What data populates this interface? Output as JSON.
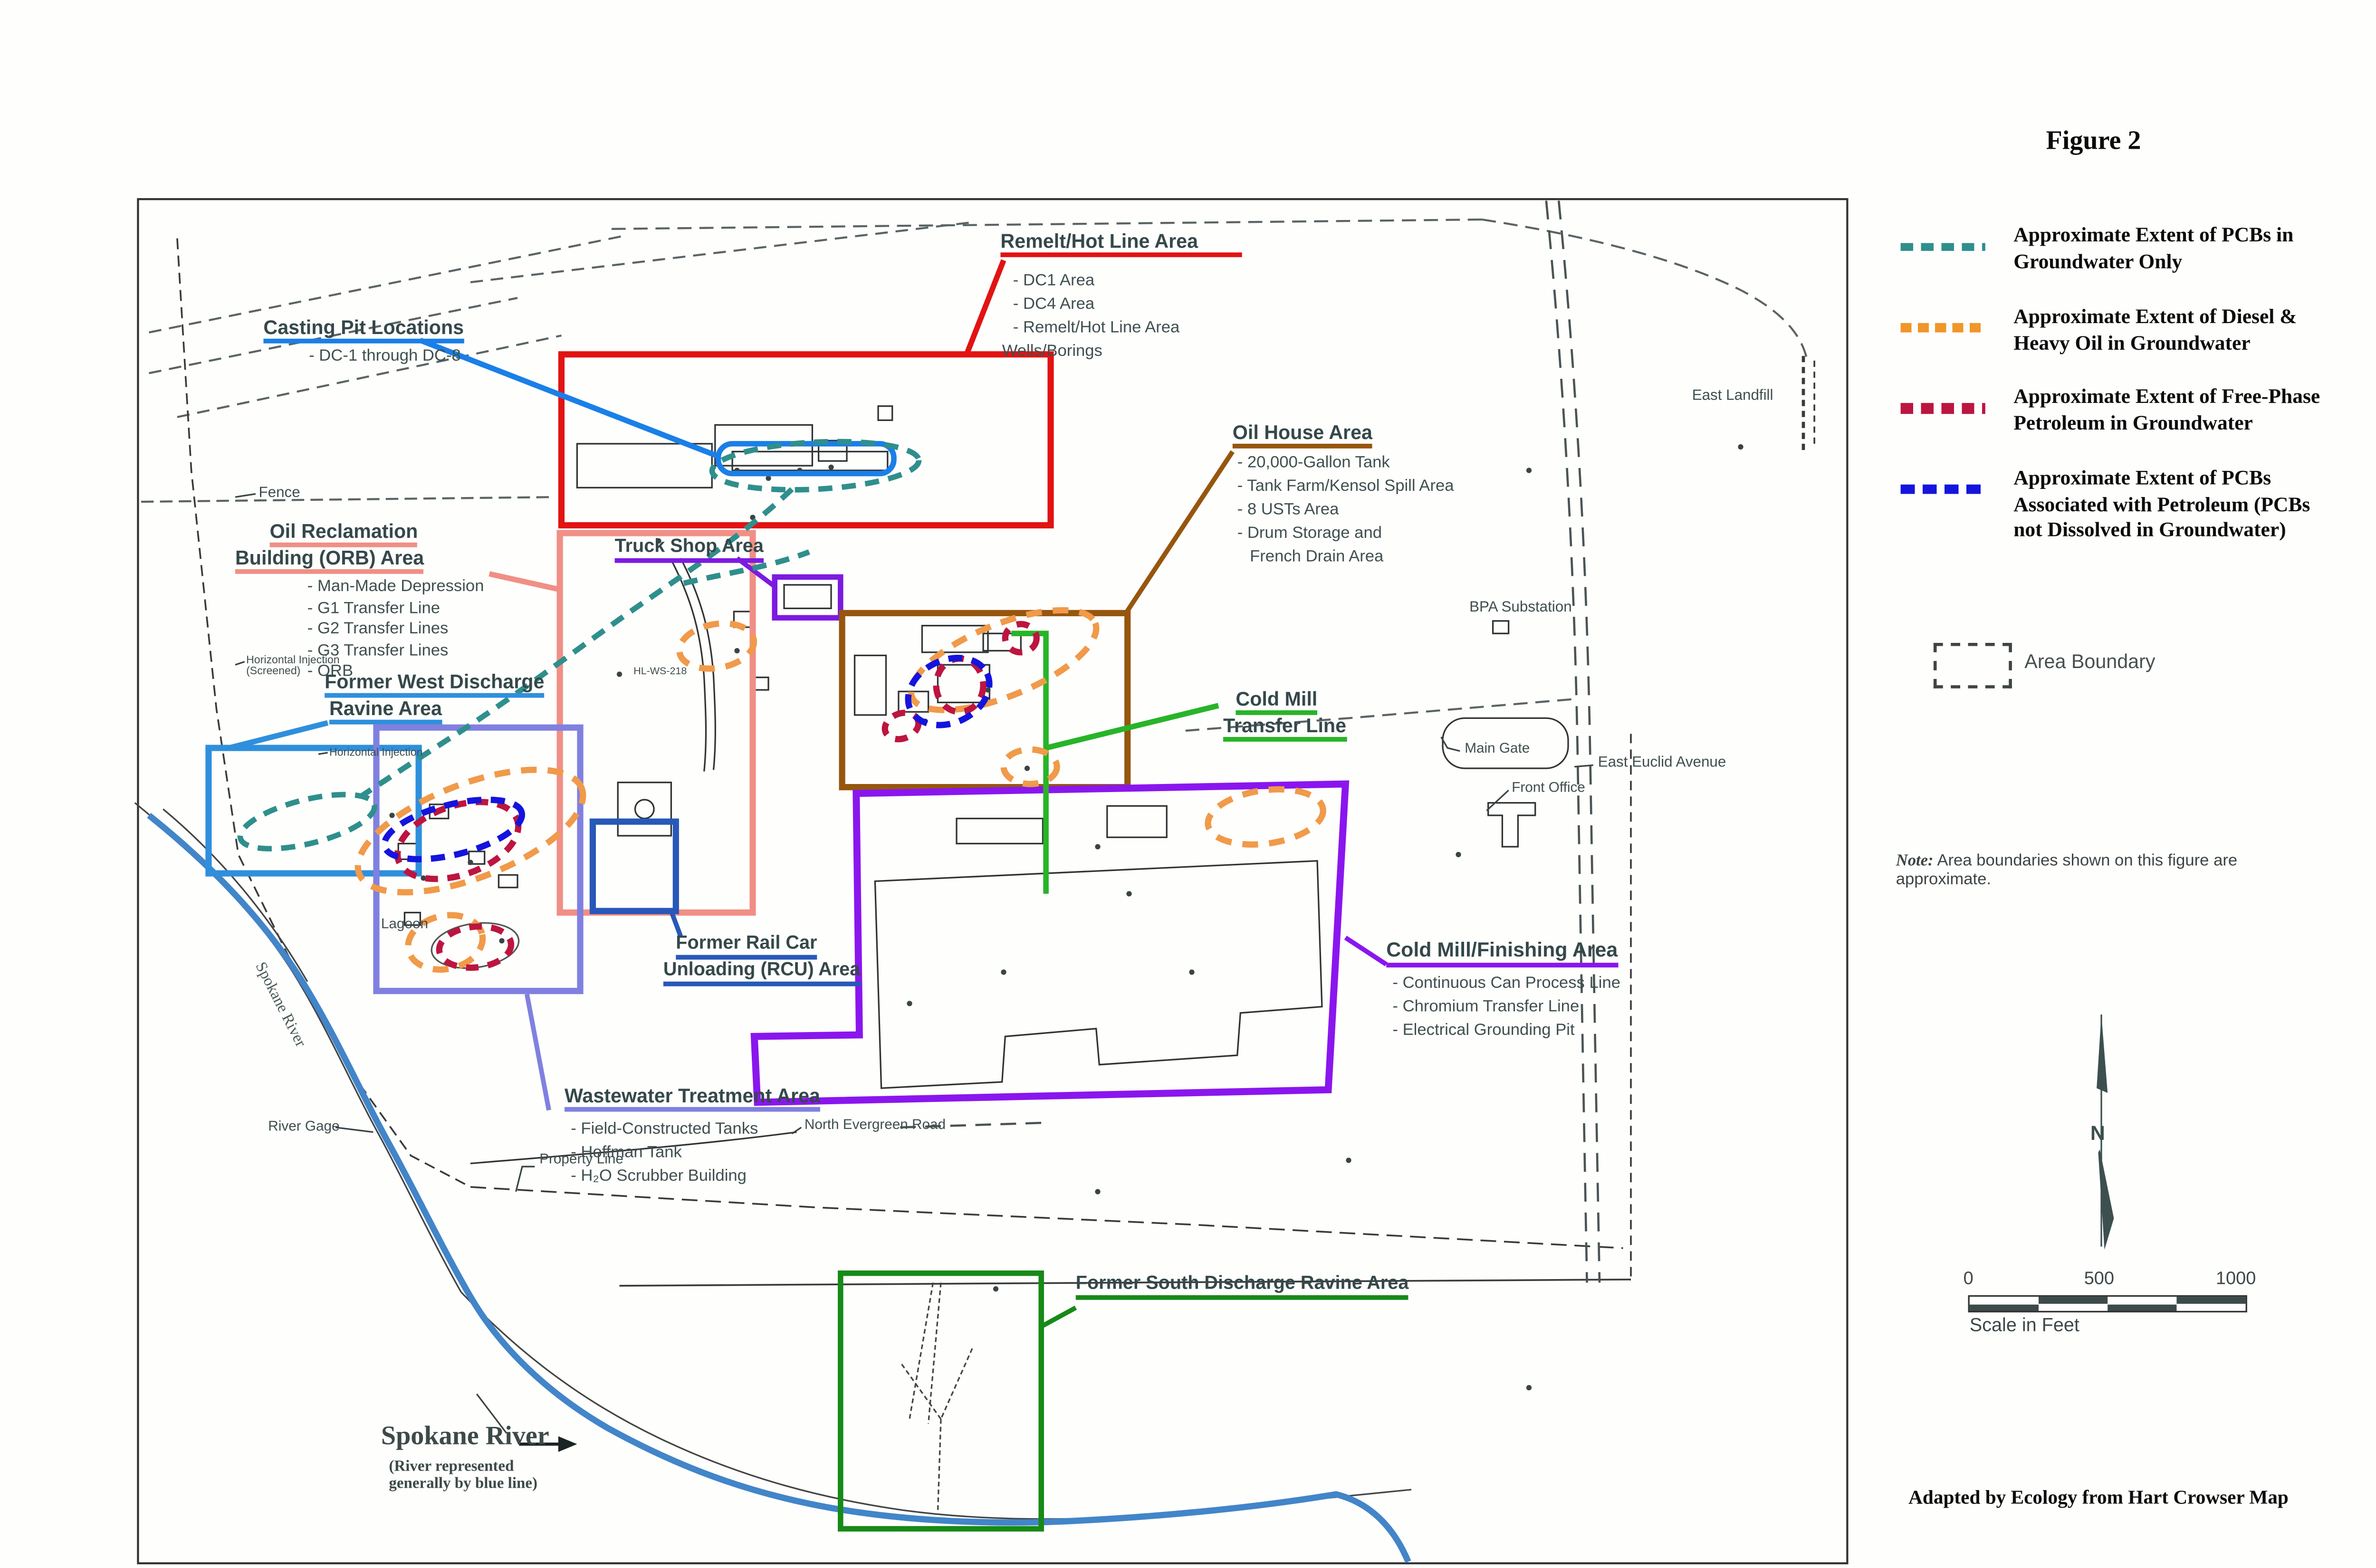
{
  "figure": {
    "title": "Figure 2",
    "north": "N",
    "note_prefix": "Note:",
    "note_text": " Area boundaries shown on this figure are approximate.",
    "credit": "Adapted by Ecology from Hart Crowser Map"
  },
  "legend": {
    "area_boundary": "Area Boundary",
    "items": [
      {
        "name": "pcbs-groundwater-only",
        "color": "#2f8f8c",
        "lines": [
          "Approximate Extent of PCBs in",
          "Groundwater Only"
        ]
      },
      {
        "name": "diesel-heavy-oil",
        "color": "#f0962a",
        "lines": [
          "Approximate Extent of Diesel &",
          "Heavy Oil in Groundwater"
        ]
      },
      {
        "name": "free-phase-petroleum",
        "color": "#bc1540",
        "lines": [
          "Approximate Extent of Free-Phase",
          "Petroleum in Groundwater"
        ]
      },
      {
        "name": "pcbs-with-petroleum",
        "color": "#1414dd",
        "lines": [
          "Approximate Extent of PCBs",
          "Associated with Petroleum (PCBs",
          "not Dissolved in Groundwater)"
        ]
      }
    ]
  },
  "scalebar": {
    "ticks": [
      "0",
      "500",
      "1000"
    ],
    "label": "Scale in Feet"
  },
  "areas": {
    "casting_pit": {
      "title": "Casting Pit Locations",
      "color": "#1a7fe8",
      "bullets": [
        "- DC-1 through DC-8"
      ]
    },
    "remelt": {
      "title": "Remelt/Hot Line Area",
      "color": "#e21313",
      "bullets": [
        "- DC1 Area",
        "- DC4 Area",
        "- Remelt/Hot Line Area",
        "Wells/Borings"
      ]
    },
    "orb": {
      "lines": [
        "Oil Reclamation",
        "Building (ORB) Area"
      ],
      "color": "#f08f86",
      "bullets": [
        "- Man-Made Depression",
        "- G1 Transfer Line",
        "- G2 Transfer Lines",
        "- G3 Transfer Lines",
        "- ORB"
      ]
    },
    "truck_shop": {
      "title": "Truck Shop Area",
      "color": "#7d1ae0"
    },
    "oil_house": {
      "title": "Oil House Area",
      "color": "#96560e",
      "bullets": [
        "- 20,000-Gallon Tank",
        "- Tank Farm/Kensol Spill Area",
        "- 8 USTs Area",
        "- Drum Storage and",
        "French Drain Area"
      ]
    },
    "cold_mill_transfer": {
      "lines": [
        "Cold Mill",
        "Transfer Line"
      ],
      "color": "#28b428"
    },
    "west_discharge": {
      "lines": [
        "Former West Discharge",
        "Ravine Area"
      ],
      "color": "#2f8fdc"
    },
    "rcu": {
      "lines": [
        "Former Rail Car",
        "Unloading (RCU) Area"
      ],
      "color": "#2858b8"
    },
    "wastewater": {
      "title": "Wastewater Treatment Area",
      "color": "#8080e0",
      "bullets": [
        "- Field-Constructed Tanks",
        "- Hoffman Tank",
        "- H₂O Scrubber Building"
      ]
    },
    "cold_mill_finishing": {
      "title": "Cold Mill/Finishing Area",
      "color": "#8a16ee",
      "bullets": [
        "- Continuous Can Process Line",
        "- Chromium Transfer Line",
        "- Electrical Grounding Pit"
      ]
    },
    "south_discharge": {
      "title": "Former South Discharge Ravine Area",
      "color": "#178a17"
    }
  },
  "river": {
    "name": "Spokane River",
    "sub": [
      "(River represented",
      "generally by blue line)"
    ],
    "rotated": "Spokane River",
    "color": "#4285c8"
  },
  "labels": {
    "fence": "Fence",
    "hinj1a": "Horizontal Injection",
    "hinj1b": "(Screened)",
    "hinj2": "Horizontal Injection",
    "hlws": "HL-WS-218",
    "lagoon": "Lagoon",
    "river_gage": "River Gage",
    "property_line": "Property Line",
    "north_evergreen": "North Evergreen Road",
    "east_landfill": "East Landfill",
    "bpa": "BPA Substation",
    "main_gate": "Main Gate",
    "front_office": "Front Office",
    "east_euclid": "East Euclid Avenue"
  },
  "colors": {
    "plume_teal": "#2f8f8c",
    "plume_orange": "#f09a4a",
    "plume_maroon": "#bc1540",
    "plume_blue": "#1414dd",
    "box_red": "#e21313",
    "box_salmon": "#f08f86",
    "box_truck_purple": "#7d1ae0",
    "box_brown": "#96560e",
    "line_green": "#28b428",
    "box_azure": "#2f8fdc",
    "box_rcu_blue": "#2858b8",
    "box_periwinkle": "#8080e0",
    "box_finishing_purple": "#8a16ee",
    "box_south_green": "#178a17",
    "river_blue": "#4285c8"
  }
}
